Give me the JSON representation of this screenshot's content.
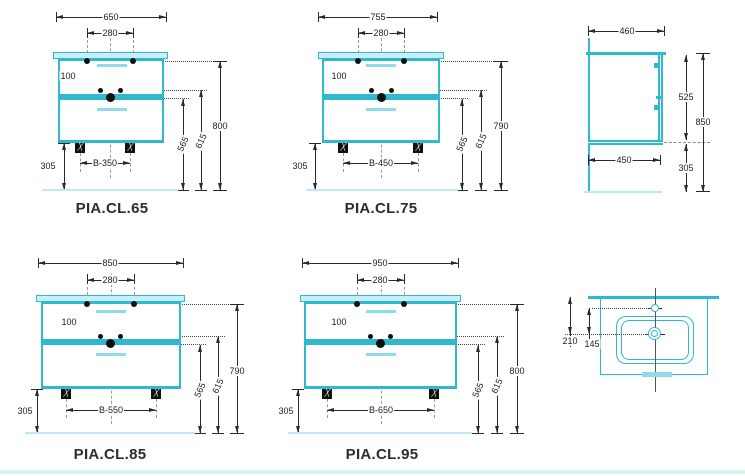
{
  "colors": {
    "accent": "#2fb9cf",
    "accent_light": "#c9eef5",
    "handle": "#8edcea",
    "floor_line": "#bfe9f0",
    "dimension_line": "#2a2a2a"
  },
  "elevations": {
    "cl65": {
      "label": "PIA.CL.65",
      "width": "650",
      "faucet_span": "280",
      "faucet_offset": "100",
      "height_total": "800",
      "height_mid": "615",
      "height_drain": "565",
      "floor_gap": "305",
      "feet_span": "B-350"
    },
    "cl75": {
      "label": "PIA.CL.75",
      "width": "755",
      "faucet_span": "280",
      "faucet_offset": "100",
      "height_total": "790",
      "height_mid": "615",
      "height_drain": "565",
      "floor_gap": "305",
      "feet_span": "B-450"
    },
    "cl85": {
      "label": "PIA.CL.85",
      "width": "850",
      "faucet_span": "280",
      "faucet_offset": "100",
      "height_total": "790",
      "height_mid": "615",
      "height_drain": "565",
      "floor_gap": "305",
      "feet_span": "B-550"
    },
    "cl95": {
      "label": "PIA.CL.95",
      "width": "950",
      "faucet_span": "280",
      "faucet_offset": "100",
      "height_total": "800",
      "height_mid": "615",
      "height_drain": "565",
      "floor_gap": "305",
      "feet_span": "B-650"
    }
  },
  "side_view": {
    "depth": "460",
    "body_height": "525",
    "height_total": "850",
    "bottom_depth": "450",
    "floor_gap": "305"
  },
  "top_view": {
    "drain_from_back": "210",
    "faucet_to_drain": "145"
  }
}
